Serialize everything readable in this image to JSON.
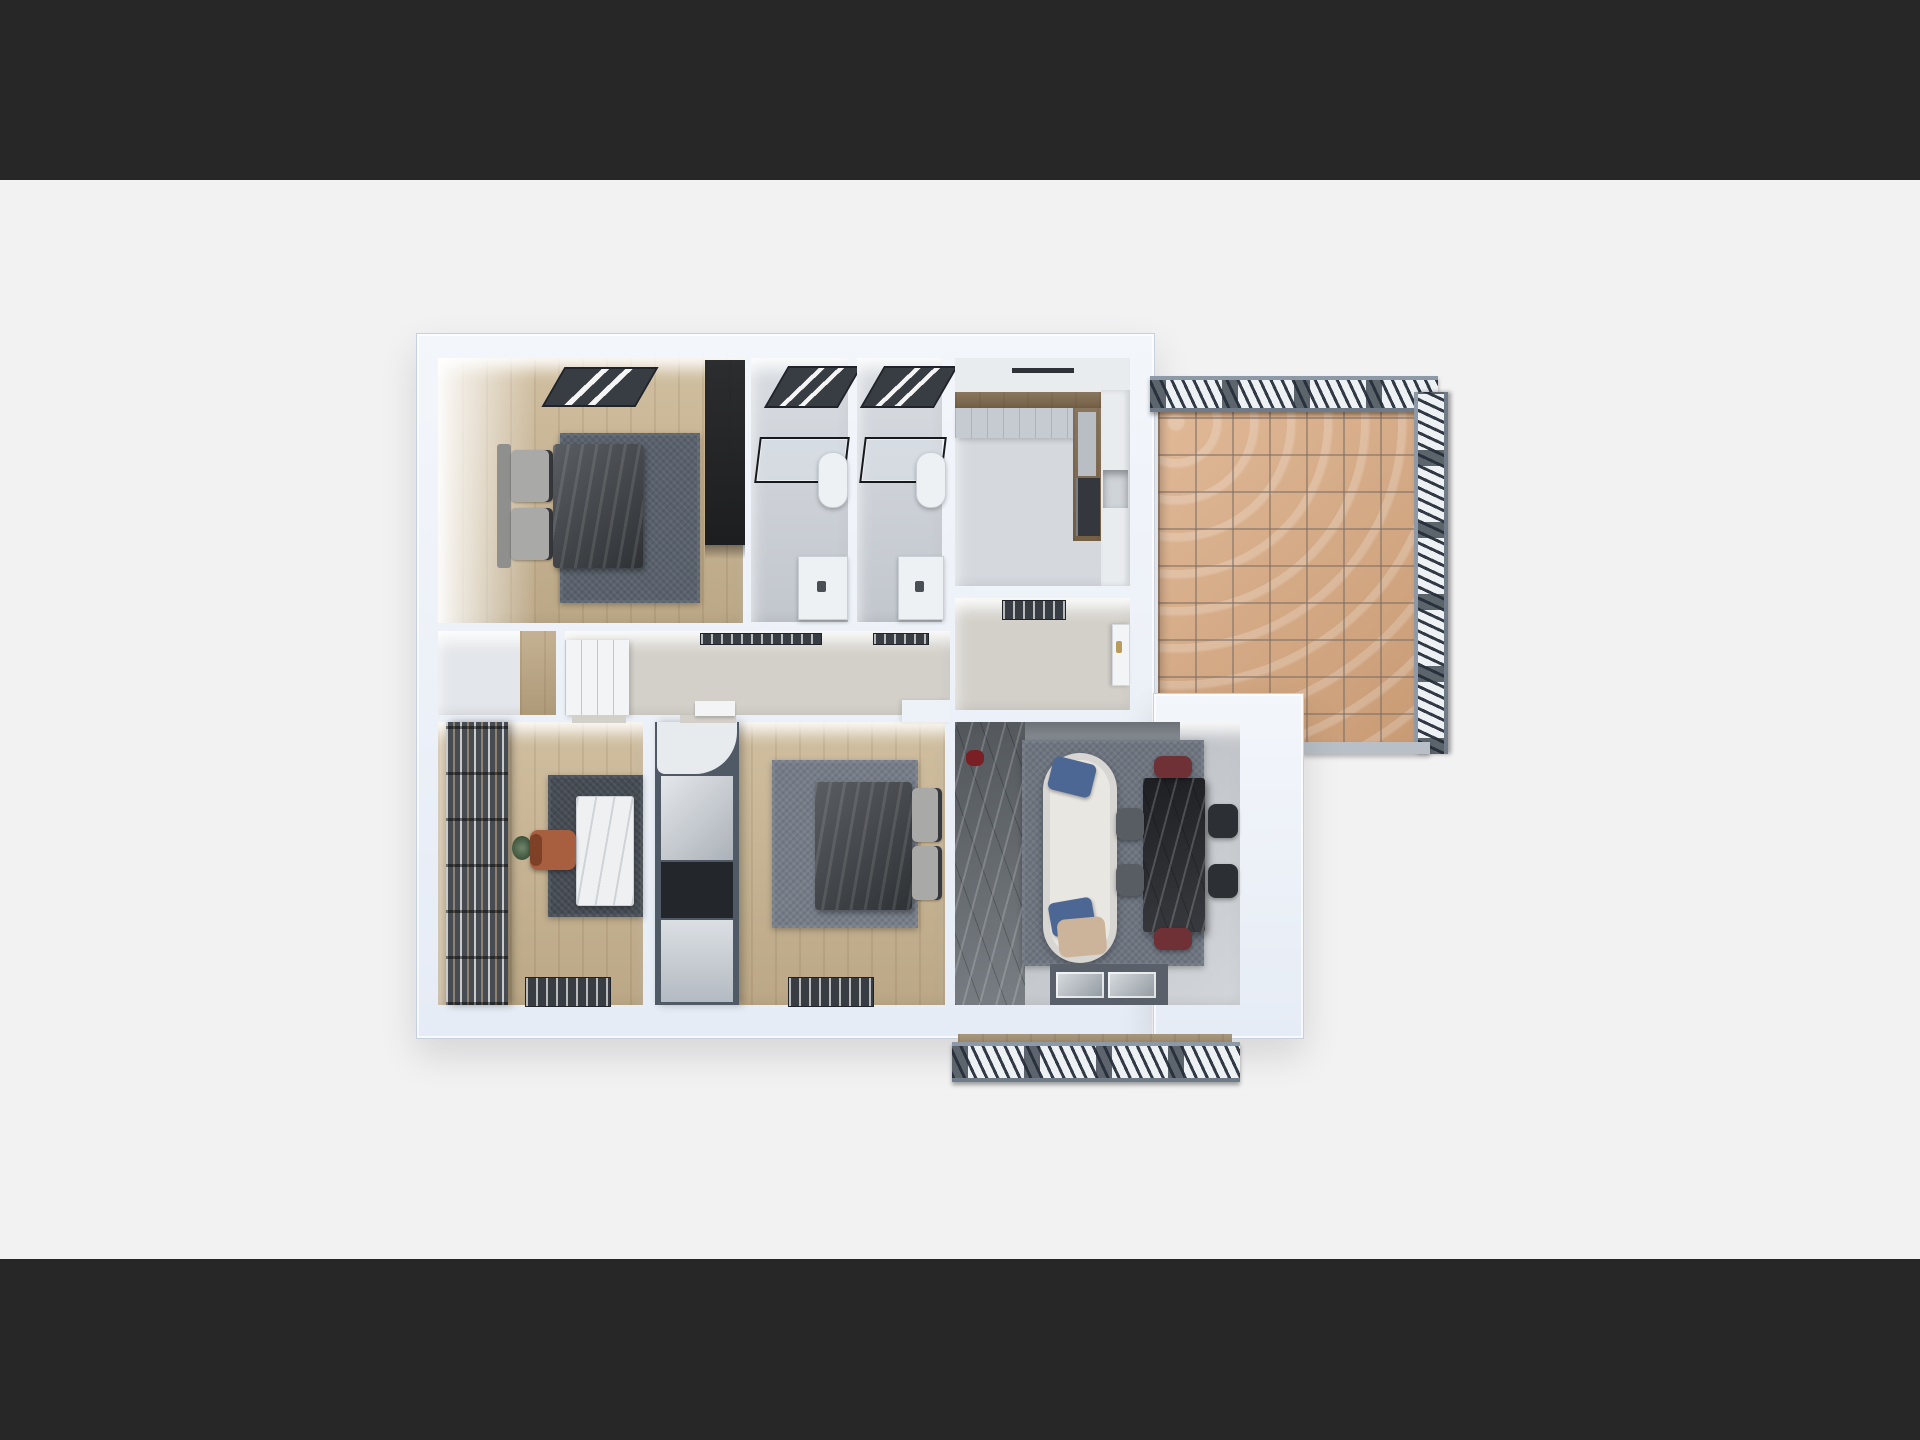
{
  "scene": {
    "title": "Top-down 3D render of an apartment floor plan",
    "view": "orthographic top view, letterboxed render",
    "rooms": [
      {
        "id": "master-bedroom",
        "label": "Master Bedroom",
        "floor": "wood",
        "items": [
          "ceiling-vent",
          "double-bed",
          "area-rug",
          "wardrobe"
        ]
      },
      {
        "id": "bathroom-1",
        "label": "Bathroom 1",
        "floor": "gray tile",
        "items": [
          "ceiling-vent",
          "shower-glass",
          "toilet",
          "vanity-sink"
        ]
      },
      {
        "id": "bathroom-2",
        "label": "Bathroom 2",
        "floor": "gray tile",
        "items": [
          "ceiling-vent",
          "shower-glass",
          "toilet",
          "vanity-sink"
        ]
      },
      {
        "id": "kitchen",
        "label": "Kitchen",
        "floor": "gray tile",
        "items": [
          "upper-cabinets",
          "l-shaped-counter",
          "refrigerator",
          "tall-cabinet"
        ]
      },
      {
        "id": "hallway",
        "label": "Hallway",
        "floor": "greige",
        "items": [
          "built-in-closet",
          "ceiling-vents",
          "door-leaf"
        ]
      },
      {
        "id": "storage-nook",
        "label": "Storage Nook",
        "floor": "light",
        "items": []
      },
      {
        "id": "entry-hall",
        "label": "Entry Hall",
        "floor": "greige",
        "items": [
          "ceiling-vent",
          "entry-door"
        ]
      },
      {
        "id": "home-office",
        "label": "Home Office",
        "floor": "wood",
        "items": [
          "bookshelf",
          "marble-desk",
          "office-chair",
          "area-rug",
          "floor-vent",
          "plant"
        ]
      },
      {
        "id": "bedroom-2",
        "label": "Bedroom 2",
        "floor": "wood",
        "items": [
          "wardrobe-column",
          "double-bed",
          "area-rug",
          "floor-vent"
        ]
      },
      {
        "id": "living-dining",
        "label": "Living / Dining Room",
        "floor": "gray marble",
        "items": [
          "curved-sofa",
          "blue-pillows",
          "throw-blanket",
          "dining-table",
          "dining-chairs",
          "area-rug",
          "sliding-glass-door",
          "red-decor-vase"
        ]
      }
    ],
    "balconies": [
      {
        "id": "side-balcony",
        "label": "Side Balcony",
        "floor": "terracotta tile",
        "items": [
          "decorative-railing-top",
          "decorative-railing-right"
        ]
      },
      {
        "id": "lower-balcony",
        "label": "Lower Balcony",
        "floor": "wood strip",
        "items": [
          "decorative-railing"
        ]
      }
    ]
  },
  "colors": {
    "letterbox": "#272727",
    "canvas": "#f2f2f3",
    "wallFill": "#edf1f8",
    "wood": "#c7b28e",
    "woodStrip": "#b9a37f",
    "bathFloor": "#ccd1d8",
    "kitchenFloor": "#d5d9de",
    "greige": "#d3d0c9",
    "nookFloor": "#e3e6ea",
    "livingFloor": "#c6cacf",
    "marbleDark": "#6d7379",
    "marbleFade": "#8a9097",
    "rugBedroom1": "#59616c",
    "rugBedroom2": "#767d88",
    "rugOffice": "#454b53",
    "rugLiving": "#6e7580",
    "duvet": "#43474c",
    "pillowLight": "#a9a9a7",
    "headboard": "#8f8f8d",
    "wardrobe1": "#43464b",
    "wardrobe2": "#505a66",
    "wardrobeCap": "#e8ebee",
    "wardrobeMirror": "#c3cad2",
    "wardrobeDarkPanel": "#23262b",
    "sofa": "#e9e7e2",
    "pillowBlue": "#4d6795",
    "blanket": "#cbb49a",
    "tableBlack": "#27292e",
    "chairRed": "#6f3036",
    "chairBlack": "#2c2f33",
    "chairGray": "#585d63",
    "deskMarble": "#eef0f2",
    "chairOrange": "#a85f3f",
    "bookshelf": "#474c52",
    "plant": "#3e5d3a",
    "tile": "#d9a87e",
    "railing": "#eef1f4",
    "vent": "#383d43",
    "appliance": "#34383e",
    "cabinetGray": "#c6cbd1",
    "cabinetWhite": "#e9ecef",
    "counterWood": "#9a7f5c",
    "glassFrame": "#596069",
    "glassPane": "#aab3bc",
    "doorWhite": "#f3f4f6",
    "handleGold": "#b99b5e",
    "decorRed": "#7a1f24",
    "balconyEdge": "#b9bfc7"
  }
}
